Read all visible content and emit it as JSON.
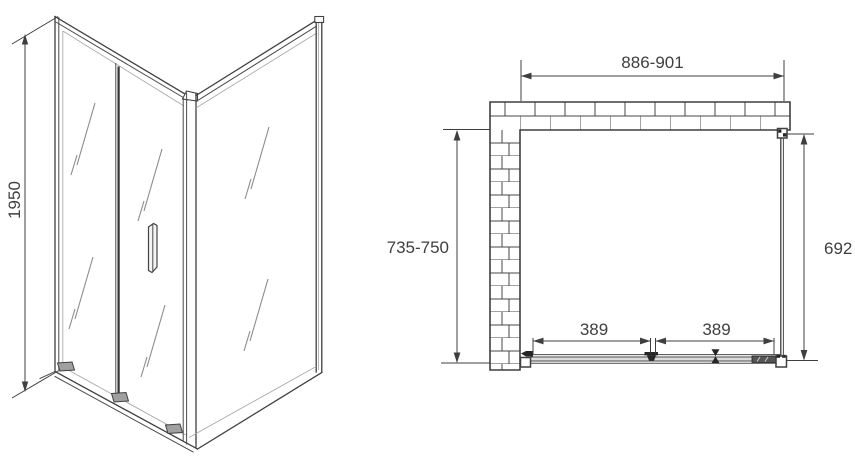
{
  "document": {
    "type": "technical-drawing",
    "subject": "corner shower enclosure with sliding door: perspective view and top plan view"
  },
  "front_view": {
    "height": "1950"
  },
  "plan_view": {
    "overall_width": "886-901",
    "depth": "735-750",
    "side_glass": "692",
    "panel_left": "389",
    "panel_right": "389"
  },
  "colors": {
    "line": "#3f3f3f",
    "light_line": "#a9a9a9",
    "glass_mark": "#8c8c8c",
    "text": "#3f3f3f",
    "track_fill": "#dcdcdc",
    "background": "#ffffff"
  }
}
